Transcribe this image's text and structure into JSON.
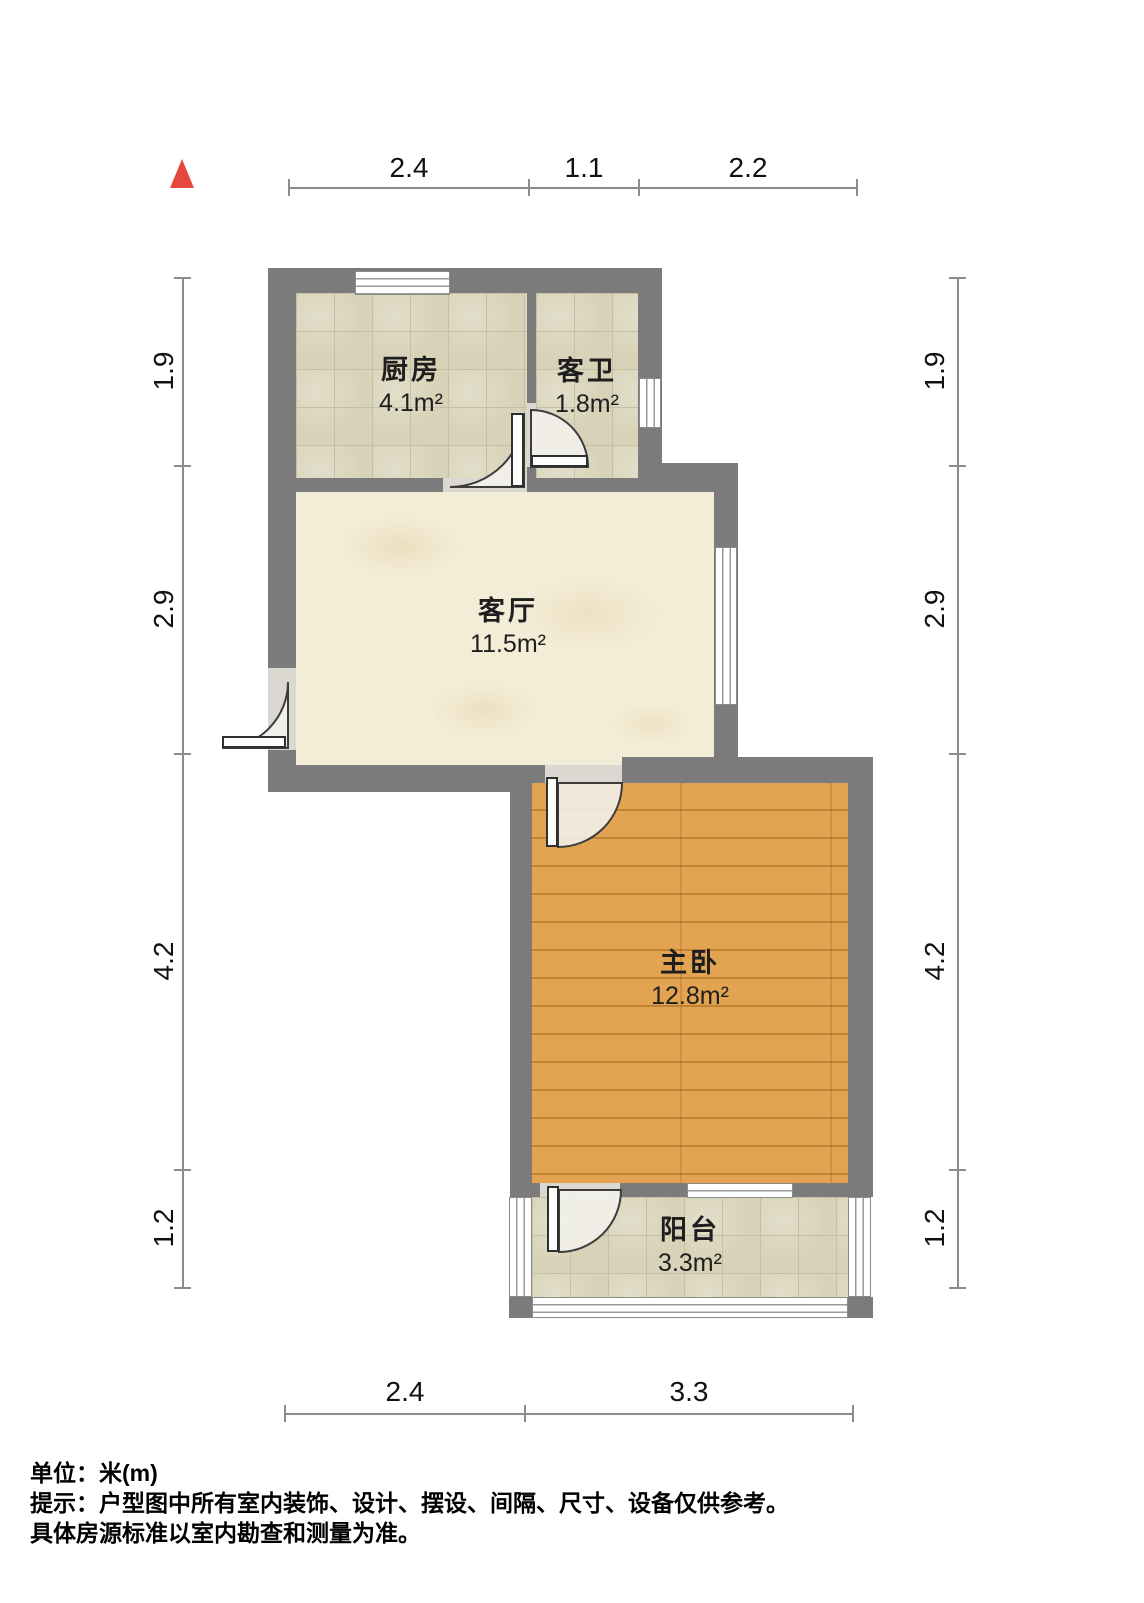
{
  "compass": {
    "type": "north-indicator",
    "color": "#e8473f"
  },
  "rooms": [
    {
      "id": "kitchen",
      "name": "厨房",
      "area": "4.1m²",
      "floor": "tile"
    },
    {
      "id": "bathroom",
      "name": "客卫",
      "area": "1.8m²",
      "floor": "tile"
    },
    {
      "id": "living",
      "name": "客厅",
      "area": "11.5m²",
      "floor": "marble"
    },
    {
      "id": "bedroom",
      "name": "主卧",
      "area": "12.8m²",
      "floor": "wood"
    },
    {
      "id": "balcony",
      "name": "阳台",
      "area": "3.3m²",
      "floor": "tile"
    }
  ],
  "dims": {
    "top": [
      "2.4",
      "1.1",
      "2.2"
    ],
    "bottom": [
      "2.4",
      "3.3"
    ],
    "left": [
      "1.9",
      "2.9",
      "4.2",
      "1.2"
    ],
    "right": [
      "1.9",
      "2.9",
      "4.2",
      "1.2"
    ]
  },
  "footer": {
    "unit": "单位：米(m)",
    "note1": "提示：户型图中所有室内装饰、设计、摆设、间隔、尺寸、设备仅供参考。",
    "note2": "具体房源标准以室内勘查和测量为准。"
  },
  "colors": {
    "wall": "#7b7b7b",
    "tile_floor": "#d8d3b8",
    "marble_floor": "#f3ecd6",
    "wood_floor": "#e2a450",
    "dim_line": "#8c8c8c",
    "compass_red": "#e8473f"
  }
}
